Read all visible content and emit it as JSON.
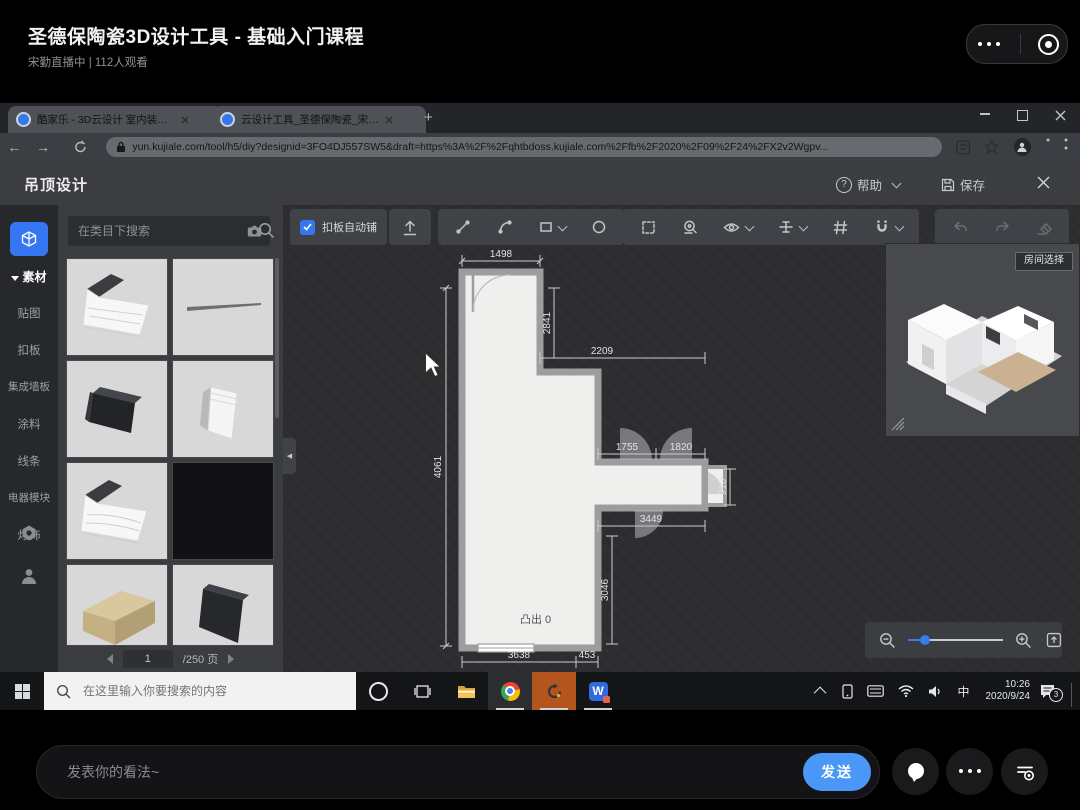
{
  "player": {
    "title": "圣德保陶瓷3D设计工具 - 基础入门课程",
    "subtitle": "宋勤直播中 | 112人观看",
    "chat": {
      "placeholder": "发表你的看法~",
      "send": "发送"
    }
  },
  "browser": {
    "tab1": "酷家乐 - 3D云设计 室内装修效",
    "tab2": "云设计工具_圣德保陶瓷_宋勤-保",
    "new_tab": "+",
    "url": "yun.kujiale.com/tool/h5/diy?designid=3FO4DJ557SW5&draft=https%3A%2F%2Fqhtbdoss.kujiale.com%2Ffb%2F2020%2F09%2F24%2FX2v2Wgpv..."
  },
  "app": {
    "title": "吊顶设计",
    "qmark": "?",
    "help": "帮助",
    "save": "保存",
    "sidebar": {
      "cat": "素材",
      "items": [
        "贴图",
        "扣板",
        "集成墙板",
        "涂料",
        "线条",
        "电器模块",
        "灯饰"
      ]
    },
    "panel": {
      "search_placeholder": "在类目下搜索",
      "page": "1",
      "page_total": "/250 页"
    },
    "toolbar": {
      "auto_tile": "扣板自动铺"
    },
    "preview": {
      "room_select": "房间选择"
    },
    "plan": {
      "dim_top": "1498",
      "dim_left": "4061",
      "dim_step_v": "2841",
      "dim_step_h": "2209",
      "dim_door_a": "1755",
      "dim_door_b": "1820",
      "dim_nub": "910",
      "dim_corridor": "3449",
      "dim_right_v": "3046",
      "dim_bottom": "3638",
      "dim_bottom_b": "453",
      "protrude": "凸出 0"
    }
  },
  "taskbar": {
    "search_placeholder": "在这里输入你要搜索的内容",
    "ime": "中",
    "wps_letter": "W",
    "time": "10:26",
    "date": "2020/9/24",
    "badge": "3"
  }
}
